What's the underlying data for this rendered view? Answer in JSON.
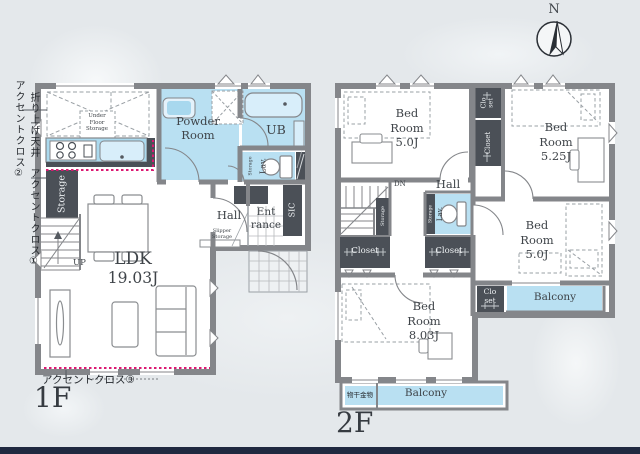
{
  "colors": {
    "wall": "#84868a",
    "water": "#b9e0f2",
    "dark_fixture": "#4b5057",
    "accent_line": "#dc1a73",
    "footer_bar": "#202940"
  },
  "compass": {
    "north": "N"
  },
  "floor1": {
    "label": "1F",
    "ldk": {
      "name": "LDK",
      "area": "19.03J"
    },
    "powder_room": {
      "line1": "Powder",
      "line2": "Room"
    },
    "ub": "UB",
    "lav": "Lav.",
    "lav_storage": "Storage",
    "storage": "Storage",
    "under_floor_storage": {
      "line1": "Under",
      "line2": "Floor",
      "line3": "Storage"
    },
    "hall": "Hall",
    "slipper_storage": {
      "line1": "Slipper",
      "line2": "Storage"
    },
    "entrance": {
      "line1": "Ent",
      "line2": "rance"
    },
    "sic": "SIC",
    "up": "UP",
    "notes": {
      "raised_ceiling": "折り上げ天井",
      "accent_cross_2": "アクセントクロス②",
      "accent_cross_1": "アクセントクロス①",
      "accent_cross_3": "アクセントクロス③"
    }
  },
  "floor2": {
    "label": "2F",
    "bedroom_nw": {
      "line1": "Bed",
      "line2": "Room",
      "line3": "5.0J"
    },
    "bedroom_ne": {
      "line1": "Bed",
      "line2": "Room",
      "line3": "5.25J"
    },
    "bedroom_e": {
      "line1": "Bed",
      "line2": "Room",
      "line3": "5.0J"
    },
    "bedroom_s": {
      "line1": "Bed",
      "line2": "Room",
      "line3": "8.03J"
    },
    "hall": "Hall",
    "dn": "DN",
    "stair_storage": "Storage",
    "lav": "Lav.",
    "lav_storage": "Storage",
    "closet_nw_upper": {
      "line1": "Clo",
      "line2": "set"
    },
    "closet_nw_lower": "Closet",
    "closet_west": "Closet",
    "closet_center": "Closet",
    "closet_south": {
      "line1": "Clo",
      "line2": "set"
    },
    "balcony_east": "Balcony",
    "balcony_south": "Balcony",
    "laundry_hardware": "物干金物"
  }
}
